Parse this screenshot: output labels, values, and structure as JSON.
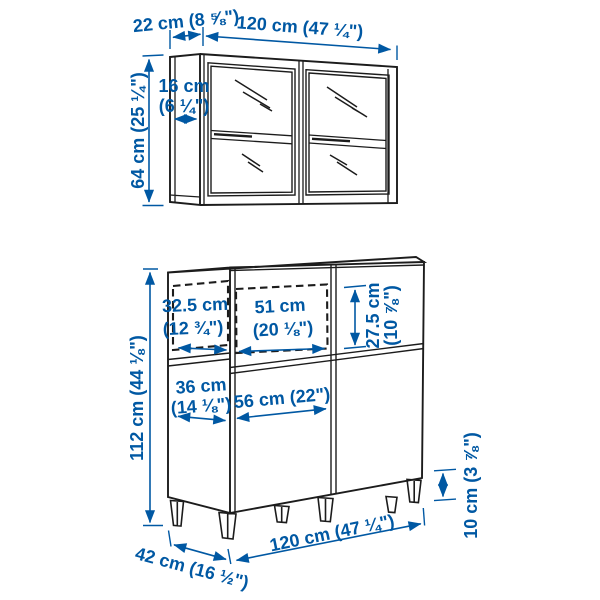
{
  "diagram_title": "Furniture dimension diagram (wall cabinet and base cabinet combination)",
  "colors": {
    "accent": "#0058a3",
    "line": "#1c1c1c",
    "background": "#ffffff"
  },
  "wall_cabinet": {
    "depth": "22 cm (8 ⅝\")",
    "width": "120 cm (47 ¼\")",
    "inner_depth_line1": "16 cm",
    "inner_depth_line2": "(6 ¼\")",
    "height": "64 cm (25 ¼\")"
  },
  "base_cabinet": {
    "inner_depth_line1": "32.5 cm",
    "inner_depth_line2": "(12 ¾\")",
    "inner_width_line1": "51 cm",
    "inner_width_line2": "(20 ⅛\")",
    "inner_height_line1": "27.5 cm",
    "inner_height_line2": "(10 ⅞\")",
    "door_width_line1": "36 cm",
    "door_width_line2": "(14 ⅛\")",
    "front_width": "56 cm (22\")",
    "height": "112 cm (44 ⅛\")",
    "leg_height": "10 cm (3 ⅞\")",
    "depth": "42 cm (16 ½\")",
    "width": "120 cm (47 ¼\")"
  }
}
